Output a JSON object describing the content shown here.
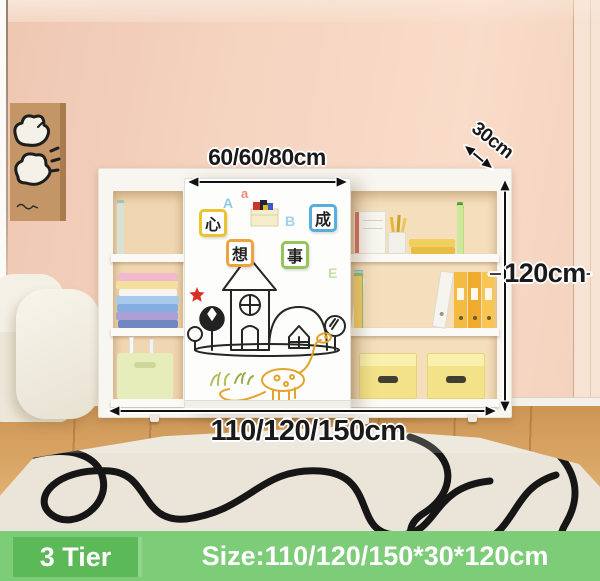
{
  "dimensions": {
    "door_width_label": "60/60/80cm",
    "depth_label": "30cm",
    "height_label": "120cm",
    "width_label": "110/120/150cm"
  },
  "footer": {
    "tier_label": "3 Tier",
    "size_label": "Size:110/120/150*30*120cm",
    "tier_box_color": "#5cb957",
    "banner_color": "#7ccc78",
    "text_color": "#ffffff"
  },
  "whiteboard": {
    "magnets": [
      {
        "char": "心",
        "border_color": "#e9c42e"
      },
      {
        "char": "想",
        "border_color": "#eda43e"
      },
      {
        "char": "事",
        "border_color": "#95c45a"
      },
      {
        "char": "成",
        "border_color": "#57aedd"
      }
    ],
    "letters": [
      {
        "char": "A",
        "color": "#8ccbe8"
      },
      {
        "char": "a",
        "color": "#e8897b"
      },
      {
        "char": "B",
        "color": "#9fd2ea"
      },
      {
        "char": "E",
        "color": "#c8e0a8"
      }
    ]
  },
  "palette": {
    "wall": "#f5d4c0",
    "floor_wood": "#d9a765",
    "rug": "#eae5d8",
    "dimension_text": "#1a1a1a"
  }
}
